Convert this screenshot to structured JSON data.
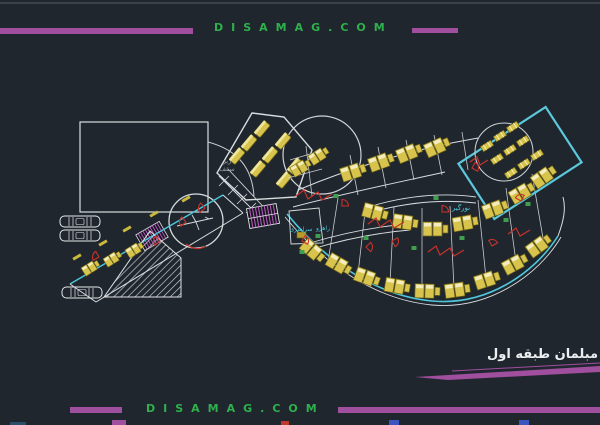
{
  "page": {
    "background": "#20262e"
  },
  "header": {
    "brand": "DISAMAG.COM",
    "brand_color": "#2eb14c",
    "bar_color": "#a04e9e"
  },
  "footer": {
    "brand": "DISAMAG.COM"
  },
  "title_block": {
    "label": "مبلمان طبقه اول"
  },
  "plan": {
    "labels": {
      "under_ceiling": "زیر\nسقف",
      "lightwell": "نورگیر",
      "corridor_1": "راهرو",
      "corridor_2": "سراسری"
    },
    "colors": {
      "wall": "#d9dde0",
      "glass_line": "#4ec7dc",
      "furniture": "#d8c44c",
      "door": "#c8322b",
      "stair_hatch": "#b257b8",
      "accent_green": "#3f9e4f"
    }
  }
}
